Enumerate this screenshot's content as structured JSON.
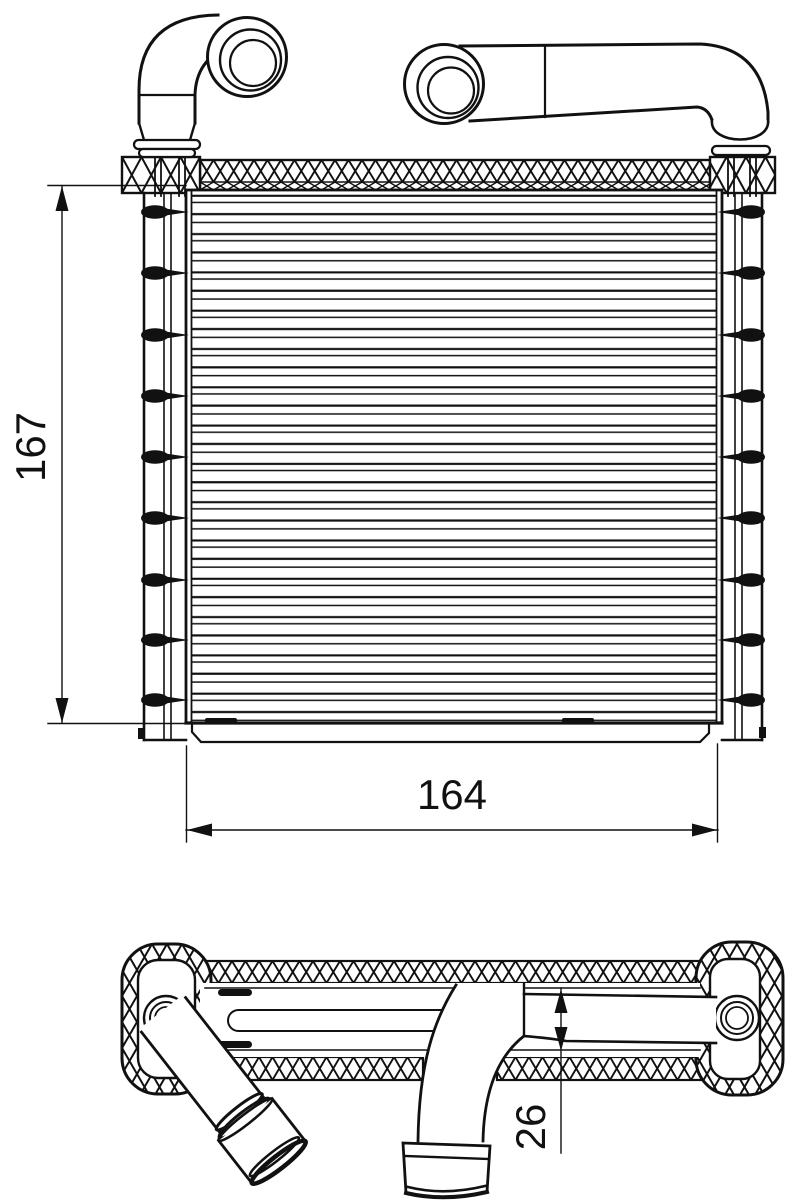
{
  "drawing": {
    "kind": "heater-core technical drawing, front view and top view"
  },
  "colors": {
    "background": "#ffffff",
    "line": "#111111"
  },
  "dimensions": {
    "height_label": "167",
    "width_label": "164",
    "depth_label": "26"
  }
}
